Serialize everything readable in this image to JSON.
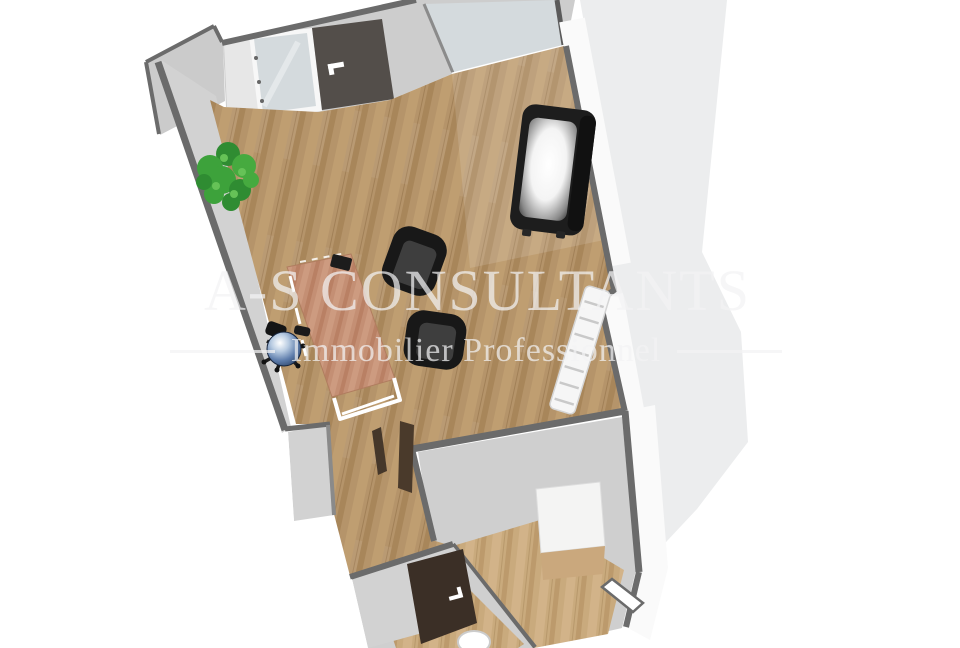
{
  "watermark": {
    "title": "A-S CONSULTANTS",
    "subtitle": "Immobilier Professionnel"
  },
  "colors": {
    "bg": "#ffffff",
    "shadow": "#ecedee",
    "wall_dark": "#6b6b6b",
    "wall_face": "#cbcbcb",
    "wall_face2": "#cdcdcd",
    "wall_face_bright": "#e7e7e7",
    "wall_interior": "#d2d2d2",
    "room_gray": "#cfcfcf",
    "wall_outer": "#fafafa",
    "frame_white": "#f7f7f7",
    "glass": "#d4dadd",
    "door_top": "#534e4a",
    "door_entry": "#3b2f26",
    "door_open": "#4a3a2b",
    "door_wedge": "#45372a",
    "wood_base": "#b5946a",
    "wood_light": "#bf9e71",
    "wood_dark": "#a8865a",
    "wood2_base": "#c9aa7d",
    "wood2_light": "#d2b389",
    "wood2_dark": "#bc9a6c",
    "desk_base": "#c48f74",
    "desk_light": "#cd9b80",
    "desk_dark": "#b98064",
    "sofa": "#1d1d1d",
    "armchair": "#181818",
    "armchair_seat": "#3e3e3e",
    "chair_blue_deep": "#1e3354",
    "plant_green": "#3da23b",
    "plant_green_dark": "#2f8c32",
    "plant_green_light": "#46aa3f",
    "plant_highlight": "#66c257",
    "plant_trunk": "#7b5333",
    "shelf_white": "#f6f6f6",
    "box_white": "#f4f4f3",
    "watermark": "rgba(242,242,244,0.72)"
  }
}
